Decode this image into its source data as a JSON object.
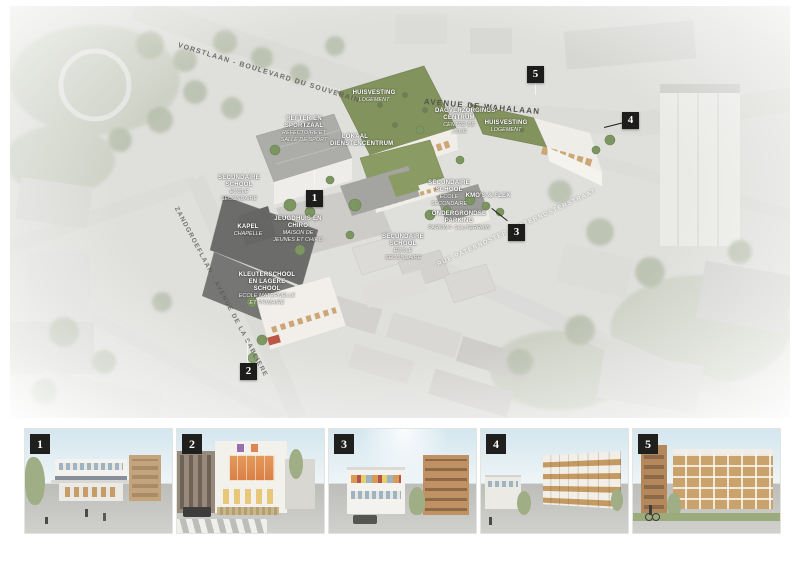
{
  "poster": {
    "type": "masterplan-aerial-diagram",
    "colors": {
      "marker_black": "#1d1d1b",
      "green_roof": "#75874b",
      "wood_accent": "#c79c66",
      "site_white": "#f0ede7",
      "backdrop_gray": "#dcdcd9",
      "charcoal_roof": "#5c5c5a"
    }
  },
  "plan": {
    "streets": [
      {
        "id": "boulevard-top",
        "name": "VORSTLAAN - BOULEVARD DU SOUVERAIN"
      },
      {
        "id": "avenue-center",
        "name": "AVENUE DE WAHALAAN"
      },
      {
        "id": "avenue-left",
        "name": "ZANDGROEFLAAN - AVENUE DE LA SABLIERE"
      },
      {
        "id": "street-right",
        "name": "RUE PATERNOSTER - PATERNOSTERSTRAAT"
      }
    ],
    "labels": [
      {
        "nl": "HUISVESTING",
        "fr": "LOGEMENT"
      },
      {
        "nl": "REFTER EN SPORTZAAL",
        "fr": "RÉFECTOIRE ET SALLE DE SPORT"
      },
      {
        "nl": "LOKAAL DIENSTENCENTRUM",
        "fr": ""
      },
      {
        "nl": "DAGVERZORGINGS- CENTRUM",
        "fr": "CENTRE DE JOUR"
      },
      {
        "nl": "HUISVESTING",
        "fr": "LOGEMENT"
      },
      {
        "nl": "SECUNDAIRE SCHOOL",
        "fr": "ECOLE SECONDAIRE"
      },
      {
        "nl": "KAPEL",
        "fr": "CHAPELLE"
      },
      {
        "nl": "JEUGDHUIS EN CHIRO",
        "fr": "MAISON DE JEUNES ET CHIRO"
      },
      {
        "nl": "KLEUTERSCHOOL EN LAGERE SCHOOL",
        "fr": "ECOLE MATERNELLE ET PRIMAIRE"
      },
      {
        "nl": "SECUNDAIRE SCHOOL",
        "fr": "ECOLE SECONDAIRE"
      },
      {
        "nl": "SECUNDAIRE SCHOOL",
        "fr": "ECOLE SECONDAIRE"
      },
      {
        "nl": "KMO'S & FLEX",
        "fr": ""
      },
      {
        "nl": "ONDERGRONDSE PARKING",
        "fr": "PARKING SOUTERRAIN"
      }
    ],
    "markers": [
      {
        "number": "1"
      },
      {
        "number": "2"
      },
      {
        "number": "3"
      },
      {
        "number": "4"
      },
      {
        "number": "5"
      }
    ]
  },
  "thumbnails": [
    {
      "number": "1"
    },
    {
      "number": "2"
    },
    {
      "number": "3"
    },
    {
      "number": "4"
    },
    {
      "number": "5"
    }
  ]
}
